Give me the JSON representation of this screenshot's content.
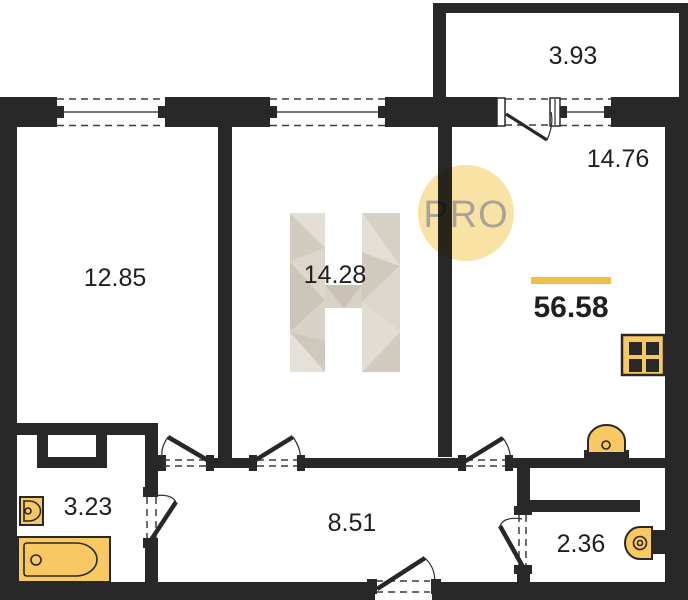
{
  "plan": {
    "watermark": {
      "badge_text": "PRO"
    },
    "rooms": {
      "balcony": "3.93",
      "living_kitchen": "14.76",
      "bedroom": "12.85",
      "bedroom2": "14.28",
      "bathroom": "3.23",
      "hallway": "8.51",
      "wc": "2.36"
    },
    "total_area": "56.58",
    "colors": {
      "wall": "#282828",
      "fixture_fill": "#F8C963",
      "accent_bar": "#F2BE45",
      "watermark_circle": "#F9E3A4",
      "watermark_text": "#A8A29A",
      "h_watermark_light": "#E5E1DA",
      "h_watermark_dark": "#CCC5B9"
    }
  }
}
